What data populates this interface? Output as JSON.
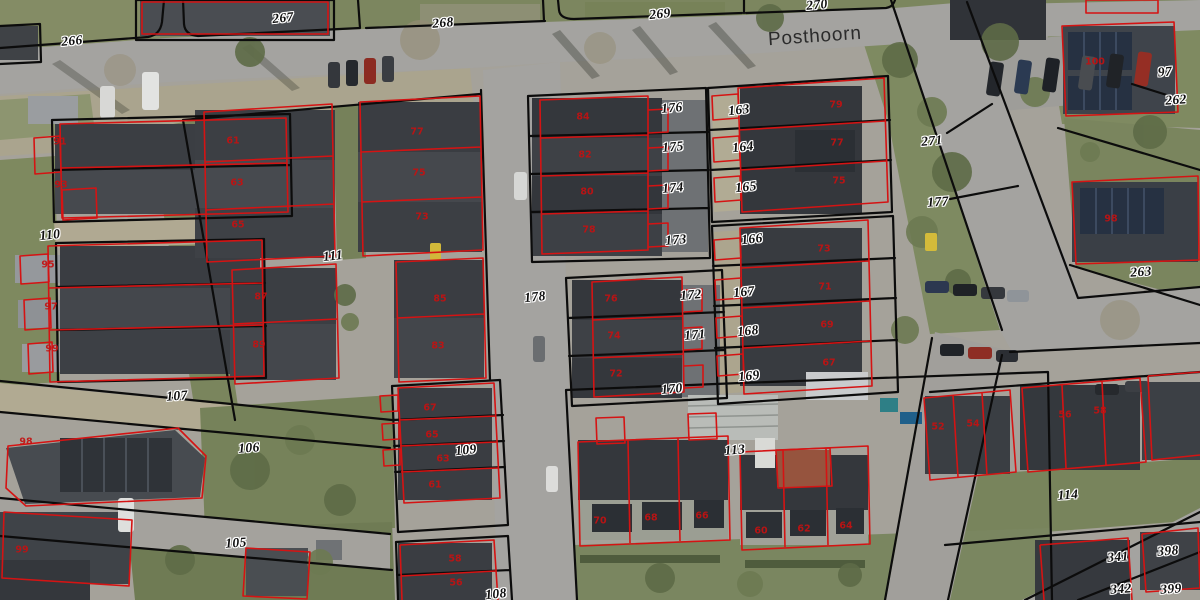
{
  "map": {
    "street_name": "Posthoorn",
    "colors": {
      "parcel_line": "#0c0c0c",
      "building_outline": "#d51313",
      "parcel_label": "#0e0e0e",
      "house_label": "#c41111",
      "road": "#a4a3a0",
      "grass": "#7c865f",
      "roof_dark": "#34373c"
    },
    "parcel_labels": [
      {
        "text": "266",
        "x": 72,
        "y": 41,
        "rot": -5
      },
      {
        "text": "267",
        "x": 283,
        "y": 18,
        "rot": -6
      },
      {
        "text": "268",
        "x": 443,
        "y": 23,
        "rot": -5
      },
      {
        "text": "269",
        "x": 660,
        "y": 14,
        "rot": -6
      },
      {
        "text": "270",
        "x": 817,
        "y": 5,
        "rot": -5
      },
      {
        "text": "271",
        "x": 932,
        "y": 141,
        "rot": -5
      },
      {
        "text": "177",
        "x": 938,
        "y": 202,
        "rot": -4
      },
      {
        "text": "178",
        "x": 535,
        "y": 297,
        "rot": -6
      },
      {
        "text": "110",
        "x": 50,
        "y": 235,
        "rot": -6
      },
      {
        "text": "111",
        "x": 333,
        "y": 256,
        "rot": -6
      },
      {
        "text": "107",
        "x": 177,
        "y": 396,
        "rot": -4
      },
      {
        "text": "106",
        "x": 249,
        "y": 448,
        "rot": -4
      },
      {
        "text": "105",
        "x": 236,
        "y": 543,
        "rot": -4
      },
      {
        "text": "109",
        "x": 466,
        "y": 450,
        "rot": -6
      },
      {
        "text": "108",
        "x": 496,
        "y": 594,
        "rot": -6
      },
      {
        "text": "176",
        "x": 672,
        "y": 108,
        "rot": -5
      },
      {
        "text": "175",
        "x": 673,
        "y": 147,
        "rot": -5
      },
      {
        "text": "174",
        "x": 673,
        "y": 188,
        "rot": -5
      },
      {
        "text": "173",
        "x": 676,
        "y": 240,
        "rot": -5
      },
      {
        "text": "172",
        "x": 691,
        "y": 295,
        "rot": -5
      },
      {
        "text": "171",
        "x": 695,
        "y": 335,
        "rot": -5
      },
      {
        "text": "170",
        "x": 672,
        "y": 389,
        "rot": -5
      },
      {
        "text": "163",
        "x": 739,
        "y": 110,
        "rot": -6
      },
      {
        "text": "164",
        "x": 743,
        "y": 147,
        "rot": -6
      },
      {
        "text": "165",
        "x": 746,
        "y": 187,
        "rot": -6
      },
      {
        "text": "166",
        "x": 752,
        "y": 239,
        "rot": -6
      },
      {
        "text": "167",
        "x": 744,
        "y": 292,
        "rot": -6
      },
      {
        "text": "168",
        "x": 748,
        "y": 331,
        "rot": -6
      },
      {
        "text": "169",
        "x": 749,
        "y": 376,
        "rot": -6
      },
      {
        "text": "113",
        "x": 735,
        "y": 450,
        "rot": -5
      },
      {
        "text": "114",
        "x": 1068,
        "y": 495,
        "rot": -4
      },
      {
        "text": "97",
        "x": 1165,
        "y": 72,
        "rot": -4
      },
      {
        "text": "262",
        "x": 1176,
        "y": 100,
        "rot": -4
      },
      {
        "text": "263",
        "x": 1141,
        "y": 272,
        "rot": -4
      },
      {
        "text": "341",
        "x": 1118,
        "y": 557,
        "rot": -4
      },
      {
        "text": "398",
        "x": 1168,
        "y": 551,
        "rot": -4
      },
      {
        "text": "342",
        "x": 1121,
        "y": 589,
        "rot": -4
      },
      {
        "text": "399",
        "x": 1171,
        "y": 589,
        "rot": -4
      }
    ],
    "house_labels": [
      {
        "text": "91",
        "x": 60,
        "y": 142
      },
      {
        "text": "93",
        "x": 61,
        "y": 185
      },
      {
        "text": "95",
        "x": 48,
        "y": 265
      },
      {
        "text": "97",
        "x": 51,
        "y": 307
      },
      {
        "text": "99",
        "x": 52,
        "y": 349
      },
      {
        "text": "98",
        "x": 26,
        "y": 442
      },
      {
        "text": "99",
        "x": 22,
        "y": 550
      },
      {
        "text": "61",
        "x": 233,
        "y": 141
      },
      {
        "text": "63",
        "x": 237,
        "y": 183
      },
      {
        "text": "65",
        "x": 238,
        "y": 225
      },
      {
        "text": "77",
        "x": 417,
        "y": 132
      },
      {
        "text": "75",
        "x": 419,
        "y": 173
      },
      {
        "text": "73",
        "x": 422,
        "y": 217
      },
      {
        "text": "87",
        "x": 261,
        "y": 297
      },
      {
        "text": "89",
        "x": 259,
        "y": 345
      },
      {
        "text": "85",
        "x": 440,
        "y": 299
      },
      {
        "text": "83",
        "x": 438,
        "y": 346
      },
      {
        "text": "84",
        "x": 583,
        "y": 117
      },
      {
        "text": "82",
        "x": 585,
        "y": 155
      },
      {
        "text": "80",
        "x": 587,
        "y": 192
      },
      {
        "text": "78",
        "x": 589,
        "y": 230
      },
      {
        "text": "76",
        "x": 611,
        "y": 299
      },
      {
        "text": "74",
        "x": 614,
        "y": 336
      },
      {
        "text": "72",
        "x": 616,
        "y": 374
      },
      {
        "text": "79",
        "x": 836,
        "y": 105
      },
      {
        "text": "77",
        "x": 837,
        "y": 143
      },
      {
        "text": "75",
        "x": 839,
        "y": 181
      },
      {
        "text": "73",
        "x": 824,
        "y": 249
      },
      {
        "text": "71",
        "x": 825,
        "y": 287
      },
      {
        "text": "69",
        "x": 827,
        "y": 325
      },
      {
        "text": "67",
        "x": 829,
        "y": 363
      },
      {
        "text": "67",
        "x": 430,
        "y": 408
      },
      {
        "text": "65",
        "x": 432,
        "y": 435
      },
      {
        "text": "63",
        "x": 443,
        "y": 459
      },
      {
        "text": "61",
        "x": 435,
        "y": 485
      },
      {
        "text": "58",
        "x": 455,
        "y": 559
      },
      {
        "text": "56",
        "x": 456,
        "y": 583
      },
      {
        "text": "70",
        "x": 600,
        "y": 521
      },
      {
        "text": "68",
        "x": 651,
        "y": 518
      },
      {
        "text": "66",
        "x": 702,
        "y": 516
      },
      {
        "text": "60",
        "x": 761,
        "y": 531
      },
      {
        "text": "62",
        "x": 804,
        "y": 529
      },
      {
        "text": "64",
        "x": 846,
        "y": 526
      },
      {
        "text": "52",
        "x": 938,
        "y": 427
      },
      {
        "text": "54",
        "x": 973,
        "y": 424
      },
      {
        "text": "56",
        "x": 1065,
        "y": 415
      },
      {
        "text": "58",
        "x": 1100,
        "y": 411
      },
      {
        "text": "100",
        "x": 1095,
        "y": 62
      },
      {
        "text": "98",
        "x": 1111,
        "y": 219
      }
    ]
  }
}
